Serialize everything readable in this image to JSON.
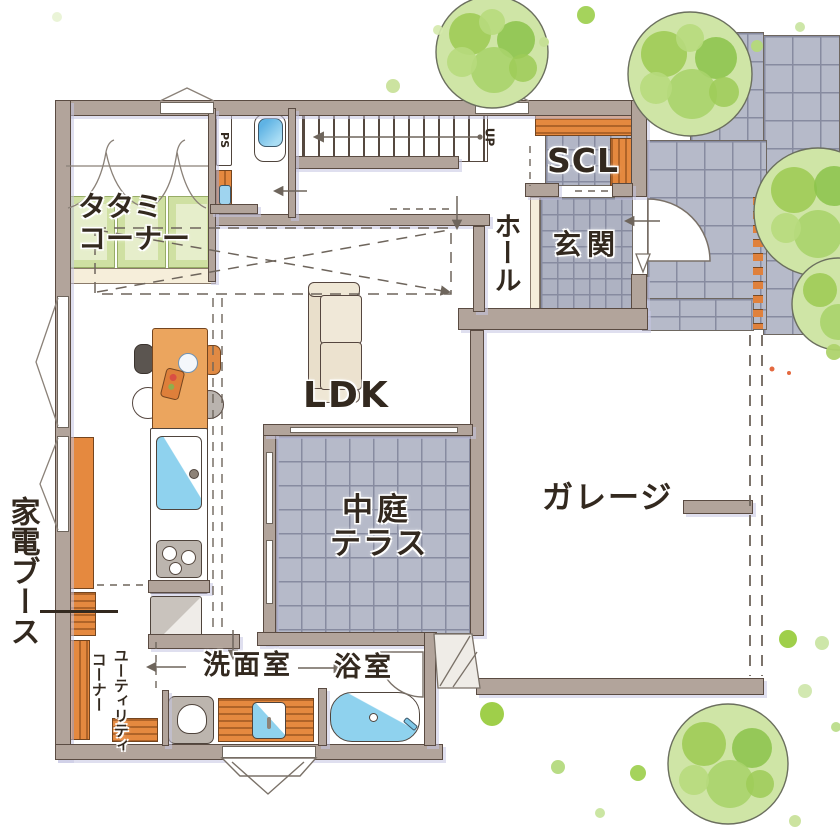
{
  "plan": {
    "rooms": {
      "tatami_corner": {
        "label_line1": "タタミ",
        "label_line2": "コーナー"
      },
      "shoe_closet": {
        "label": "SCL"
      },
      "hall": {
        "label": "ホール"
      },
      "entrance": {
        "label": "玄関"
      },
      "ldk": {
        "label": "LDK"
      },
      "courtyard_terrace": {
        "label_line1": "中庭",
        "label_line2": "テラス"
      },
      "garage": {
        "label": "ガレージ"
      },
      "appliance_booth": {
        "label": "家電ブース"
      },
      "utility_corner": {
        "label_line1": "ユーティリティ",
        "label_line2": "コーナー"
      },
      "washroom": {
        "label": "洗面室"
      },
      "bathroom": {
        "label": "浴室"
      }
    },
    "annotations": {
      "pipe_space": "PS",
      "stairs_up": "UP"
    },
    "colors": {
      "wall": "#b2a49b",
      "wall_outline": "#5a4b42",
      "wood_orange": "#e5893f",
      "tatami_green": "#cfe0a2",
      "tile_gray": "#b6bac9",
      "water_blue": "#8fd2ee",
      "foliage_green": "#9ecb57",
      "foliage_light": "#cfe5a6",
      "shadow_lavender": "#c5c5e2",
      "text": "#33291f"
    }
  }
}
